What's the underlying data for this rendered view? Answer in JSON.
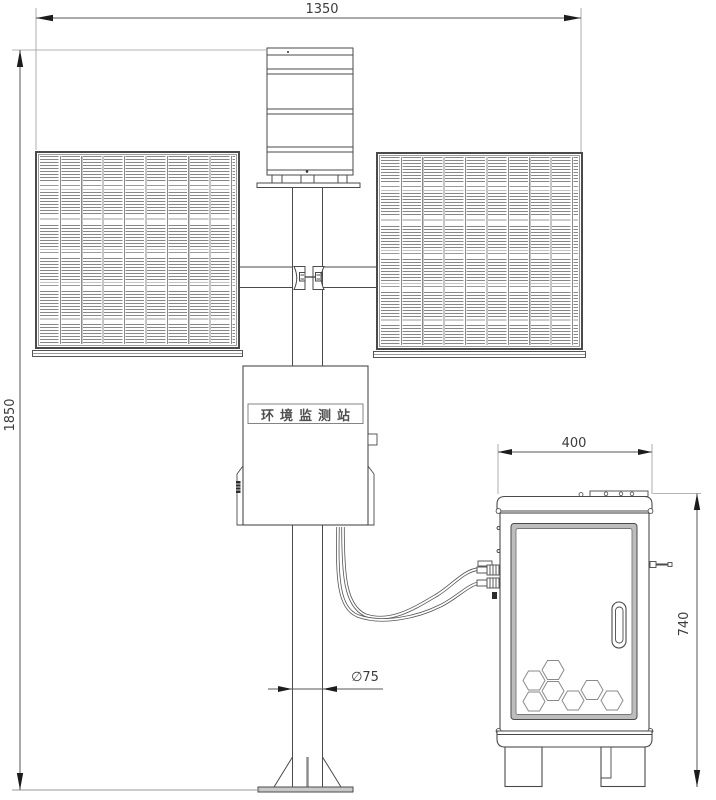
{
  "labels": {
    "dim_overall_width": "1350",
    "dim_overall_height": "1850",
    "dim_cabinet_width": "400",
    "dim_cabinet_height": "740",
    "dim_pole_diameter": "∅75",
    "station_box_label": "环境监测站"
  },
  "colors": {
    "line": "#4a4a4a",
    "dim_line": "#555555",
    "base_plate_fill": "#c9c9c9"
  }
}
